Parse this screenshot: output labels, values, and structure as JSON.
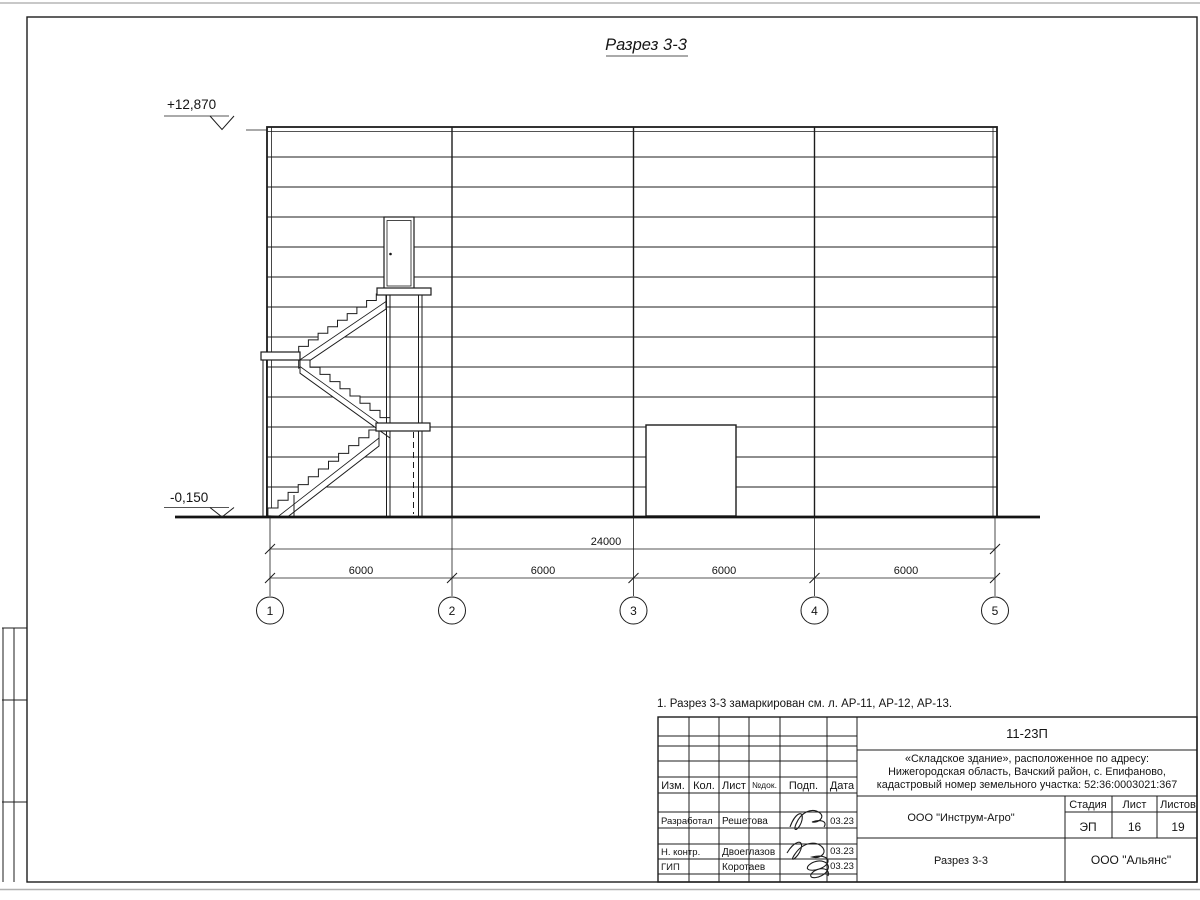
{
  "page": {
    "title": "Разрез 3-3",
    "note": "1. Разрез 3-3 замаркирован см. л. АР-11, АР-12, АР-13."
  },
  "drawing": {
    "elevation_top": "+12,870",
    "elevation_bottom": "-0,150",
    "dim_total": "24000",
    "dim_spans": [
      "6000",
      "6000",
      "6000",
      "6000"
    ],
    "axes": [
      "1",
      "2",
      "3",
      "4",
      "5"
    ]
  },
  "titleblock": {
    "doc_number": "11-23П",
    "project_line1": "«Складское здание», расположенное по адресу:",
    "project_line2": "Нижегородская область, Вачский район, с. Епифаново,",
    "project_line3": "кадастровый номер земельного участка: 52:36:0003021:367",
    "columns": {
      "izm": "Изм.",
      "kol": "Кол.",
      "list": "Лист",
      "ndok": "№док.",
      "podp": "Подп.",
      "data": "Дата"
    },
    "rows": [
      {
        "role": "Разработал",
        "name": "Решетова",
        "date": "03.23"
      },
      {
        "role": "Н. контр.",
        "name": "Двоеглазов",
        "date": "03.23"
      },
      {
        "role": "ГИП",
        "name": "Коротаев",
        "date": "03.23"
      }
    ],
    "org1": "ООО \"Инструм-Агро\"",
    "sheet_title": "Разрез 3-3",
    "org2": "ООО \"Альянс\"",
    "stage_label": "Стадия",
    "sheet_label": "Лист",
    "sheets_label": "Листов",
    "stage": "ЭП",
    "sheet": "16",
    "sheets": "19"
  }
}
